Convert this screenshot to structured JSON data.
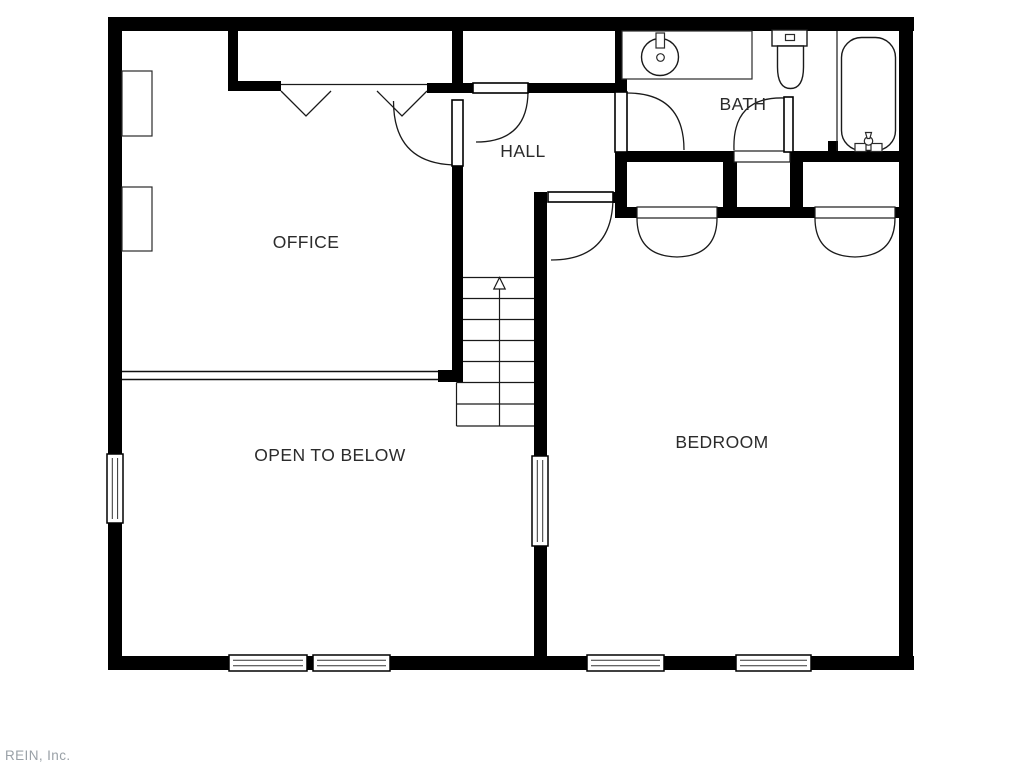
{
  "rooms": {
    "office": {
      "label": "OFFICE"
    },
    "hall": {
      "label": "HALL"
    },
    "bath": {
      "label": "BATH"
    },
    "bedroom": {
      "label": "BEDROOM"
    },
    "open_to_below": {
      "label": "OPEN TO BELOW"
    }
  },
  "watermark": {
    "text": "REIN, Inc."
  },
  "colors": {
    "walls": "#000000",
    "background": "#ffffff",
    "room_label": "#2b2b2b",
    "watermark": "#9aa1a7"
  },
  "fixtures": {
    "bath": [
      "vanity-counter",
      "sink",
      "toilet",
      "bathtub"
    ],
    "bedroom": [
      "closet-bifold-doors-left",
      "closet-bifold-doors-right"
    ],
    "office": [
      "closet-double-doors",
      "shelf-left-upper",
      "shelf-left-lower"
    ],
    "stairs": {
      "direction": "up"
    }
  }
}
